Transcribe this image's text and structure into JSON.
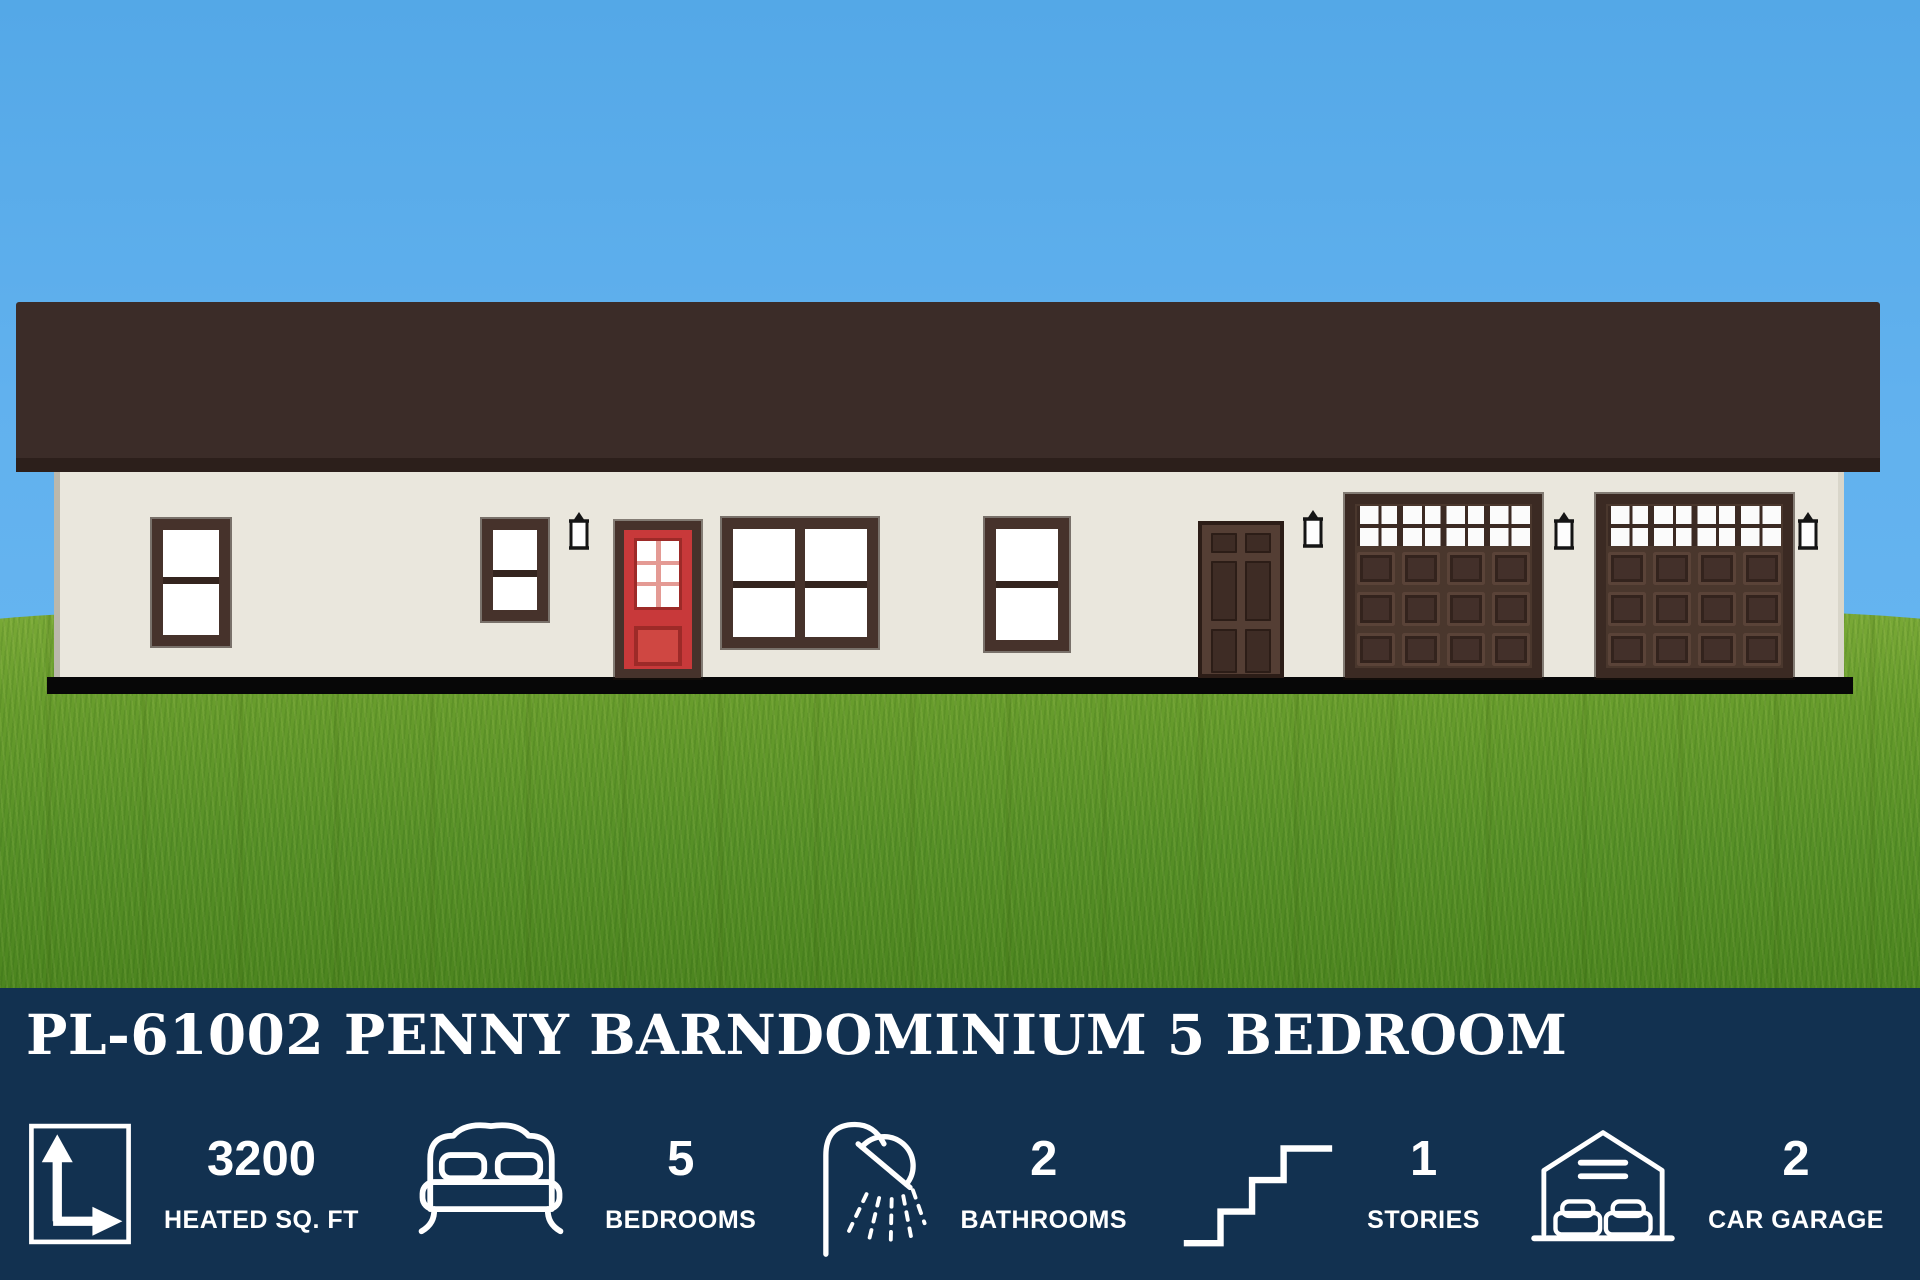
{
  "banner": {
    "title": "PL-61002 PENNY BARNDOMINIUM 5 BEDROOM",
    "stats": [
      {
        "icon": "area-measure-icon",
        "value": "3200",
        "label": "HEATED SQ. FT"
      },
      {
        "icon": "bed-icon",
        "value": "5",
        "label": "BEDROOMS"
      },
      {
        "icon": "shower-icon",
        "value": "2",
        "label": "BATHROOMS"
      },
      {
        "icon": "stairs-icon",
        "value": "1",
        "label": "STORIES"
      },
      {
        "icon": "garage-icon",
        "value": "2",
        "label": "CAR GARAGE"
      }
    ]
  },
  "house": {
    "features": [
      "front-door-red",
      "entry-door",
      "garage-door",
      "garage-door"
    ],
    "window_count": 4,
    "lantern_count": 4
  },
  "colors": {
    "banner_navy": "#123150",
    "sky_blue": "#5fb0ec",
    "grass_green": "#5f9428",
    "roof_brown": "#3b2c28",
    "wall_cream": "#eae7dd",
    "trim_brown": "#46322b",
    "front_door_red": "#c8393a",
    "entry_door_brown": "#543e34",
    "garage_door_brown": "#4a372d",
    "foundation_black": "#070707",
    "text_white": "#ffffff"
  }
}
